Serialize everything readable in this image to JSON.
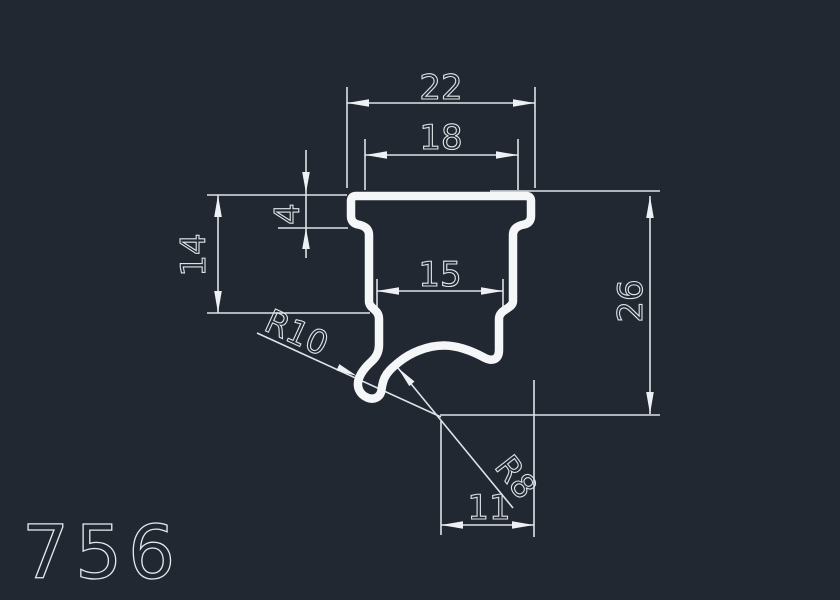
{
  "drawing": {
    "part_number": "756",
    "dimensions": {
      "top_width": "22",
      "upper_inner_width": "18",
      "lip_height": "4",
      "left_side_height": "14",
      "neck_width": "15",
      "overall_height": "26",
      "bottom_width": "11",
      "outer_radius": "R10",
      "inner_radius": "R8"
    },
    "colors": {
      "background": "#212832",
      "dimension_lines": "#dfe3e7",
      "profile_outline": "#f4f6f8"
    }
  }
}
